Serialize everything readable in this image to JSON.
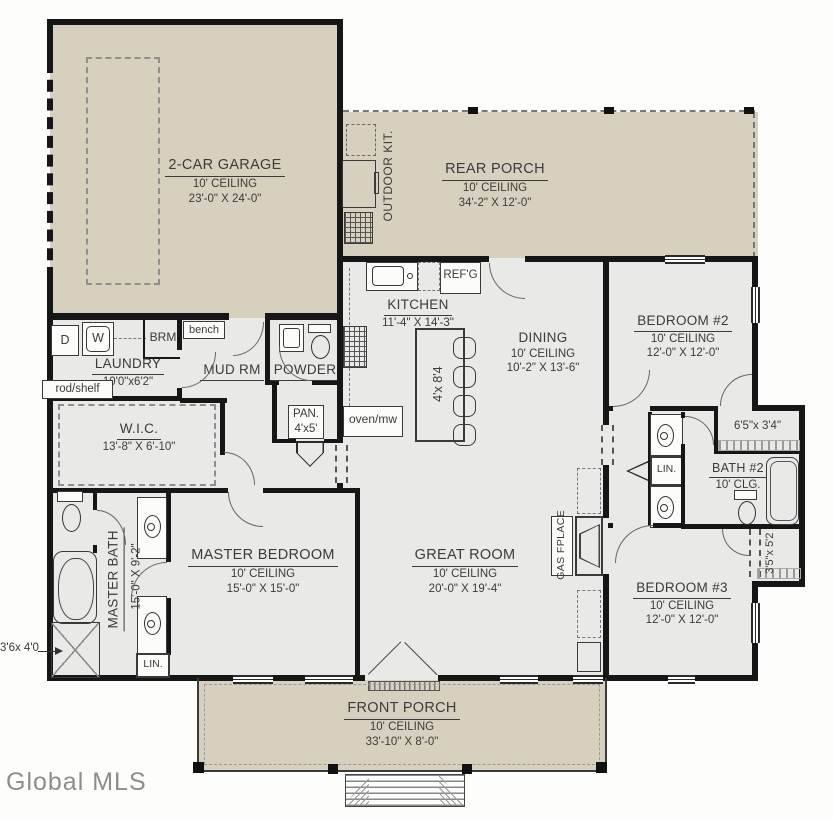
{
  "watermark": "Global MLS",
  "colors": {
    "porch_tan": "#d8d0bf",
    "interior_gray": "#e9e9e7",
    "wall_black": "#161616",
    "text": "#3b3b3b",
    "background": "#fdfdfb"
  },
  "rooms": {
    "garage": {
      "name": "2-CAR GARAGE",
      "ceiling": "10' CEILING",
      "dims": "23'-0\" X 24'-0\""
    },
    "rear_porch": {
      "name": "REAR PORCH",
      "ceiling": "10' CEILING",
      "dims": "34'-2\" X 12'-0\""
    },
    "front_porch": {
      "name": "FRONT PORCH",
      "ceiling": "10' CEILING",
      "dims": "33'-10\" X 8'-0\""
    },
    "kitchen": {
      "name": "KITCHEN",
      "dims": "11'-4\" X 14'-3\""
    },
    "dining": {
      "name": "DINING",
      "ceiling": "10' CEILING",
      "dims": "10'-2\" X 13'-6\""
    },
    "great_room": {
      "name": "GREAT ROOM",
      "ceiling": "10' CEILING",
      "dims": "20'-0\" X 19'-4\""
    },
    "master_bedroom": {
      "name": "MASTER BEDROOM",
      "ceiling": "10' CEILING",
      "dims": "15'-0\" X 15'-0\""
    },
    "bedroom2": {
      "name": "BEDROOM #2",
      "ceiling": "10' CEILING",
      "dims": "12'-0\" X 12'-0\""
    },
    "bedroom3": {
      "name": "BEDROOM #3",
      "ceiling": "10' CEILING",
      "dims": "12'-0\" X 12'-0\""
    },
    "master_bath": {
      "name": "MASTER BATH",
      "dims": "15'-0\" X 9'-2\""
    },
    "bath2": {
      "name": "BATH #2",
      "ceiling": "10' CLG."
    },
    "wic": {
      "name": "W.I.C.",
      "dims": "13'-8\" X 6'-10\""
    },
    "laundry": {
      "name": "LAUNDRY",
      "dims": "10'0\"x6'2\""
    },
    "mud_room": {
      "name": "MUD RM"
    },
    "powder": {
      "name": "POWDER"
    },
    "pantry": {
      "name": "PAN.",
      "dims": "4'x5'"
    }
  },
  "labels": {
    "outdoor_kitchen": "OUTDOOR KIT.",
    "refrigerator": "REF'G",
    "oven_microwave": "oven/mw",
    "island_dims": "4'x 8'4",
    "gas_fireplace": "GAS FPLACE",
    "bench": "bench",
    "broom_closet": "BRM",
    "rod_shelf": "rod/shelf",
    "dryer": "D",
    "washer": "W",
    "linen_master": "LIN.",
    "linen_hall": "LIN.",
    "closet_bedroom2_dims": "6'5\"x 3'4\"",
    "closet_bedroom3_dims": "3'5\"x 5'2",
    "shower_dims": "3'6x 4'0"
  }
}
